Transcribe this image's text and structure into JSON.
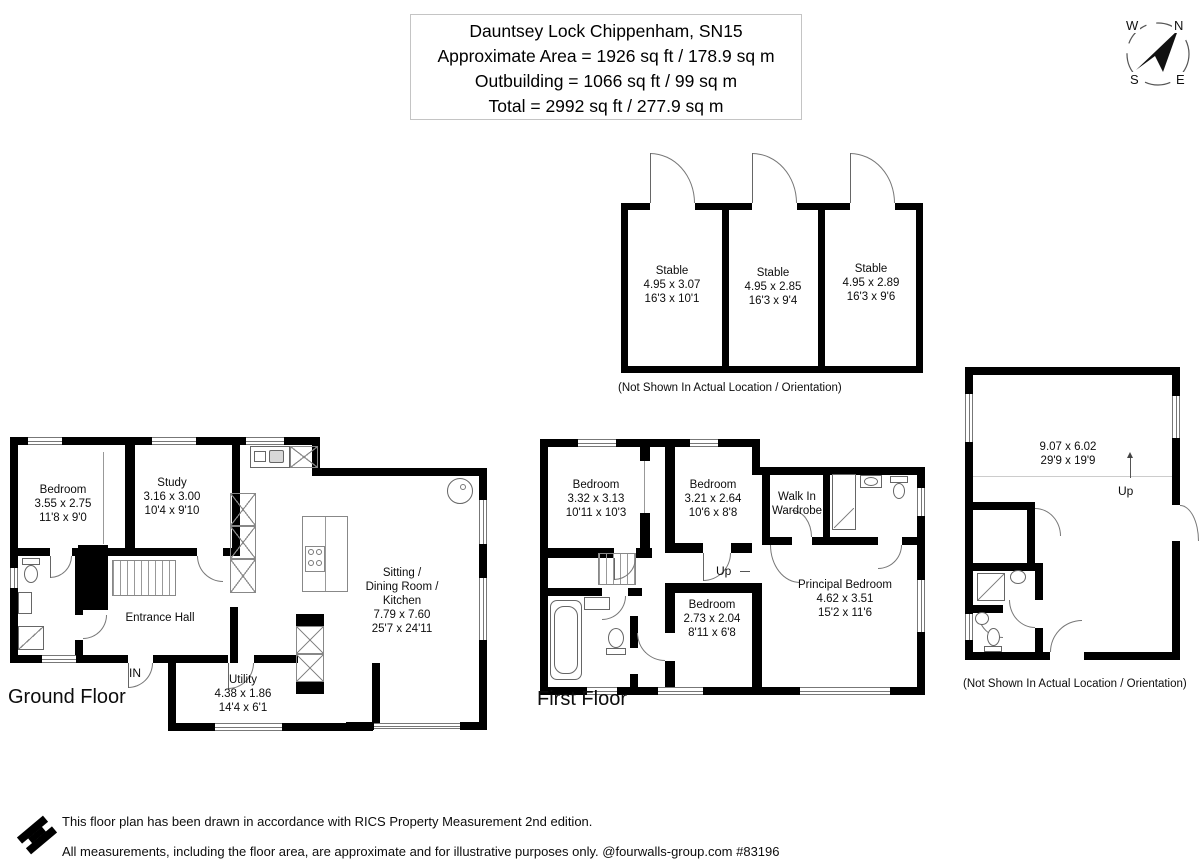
{
  "title_block": {
    "line1": "Dauntsey Lock Chippenham, SN15",
    "line2": "Approximate Area = 1926 sq ft / 178.9 sq m",
    "line3": "Outbuilding = 1066 sq ft / 99 sq m",
    "line4": "Total = 2992 sq ft / 277.9 sq m"
  },
  "compass": {
    "north": "N",
    "east": "E",
    "south": "S",
    "west": "W"
  },
  "stables": {
    "note": "(Not Shown In Actual Location / Orientation)",
    "rooms": [
      {
        "name": "Stable",
        "metric": "4.95 x 3.07",
        "imperial": "16'3 x 10'1"
      },
      {
        "name": "Stable",
        "metric": "4.95 x 2.85",
        "imperial": "16'3 x 9'4"
      },
      {
        "name": "Stable",
        "metric": "4.95 x 2.89",
        "imperial": "16'3 x 9'6"
      }
    ]
  },
  "ground_floor": {
    "label": "Ground Floor",
    "entrance_label": "IN",
    "rooms": {
      "bedroom": {
        "name": "Bedroom",
        "metric": "3.55 x 2.75",
        "imperial": "11'8 x 9'0"
      },
      "study": {
        "name": "Study",
        "metric": "3.16 x 3.00",
        "imperial": "10'4 x 9'10"
      },
      "sitting": {
        "line1": "Sitting /",
        "line2": "Dining Room /",
        "line3": "Kitchen",
        "metric": "7.79 x 7.60",
        "imperial": "25'7 x 24'11"
      },
      "entrance_hall": {
        "name": "Entrance Hall"
      },
      "utility": {
        "name": "Utility",
        "metric": "4.38 x 1.86",
        "imperial": "14'4 x 6'1"
      }
    }
  },
  "first_floor": {
    "label": "First Floor",
    "up_label": "Up",
    "rooms": {
      "bedroom1": {
        "name": "Bedroom",
        "metric": "3.32 x 3.13",
        "imperial": "10'11 x 10'3"
      },
      "bedroom2": {
        "name": "Bedroom",
        "metric": "3.21 x 2.64",
        "imperial": "10'6 x 8'8"
      },
      "walk_in_wardrobe": {
        "line1": "Walk In",
        "line2": "Wardrobe"
      },
      "principal": {
        "name": "Principal Bedroom",
        "metric": "4.62 x 3.51",
        "imperial": "15'2 x 11'6"
      },
      "bedroom3": {
        "name": "Bedroom",
        "metric": "2.73 x 2.04",
        "imperial": "8'11 x 6'8"
      }
    }
  },
  "outbuilding": {
    "metric": "9.07 x 6.02",
    "imperial": "29'9 x 19'9",
    "up_label": "Up",
    "note": "(Not Shown In Actual Location / Orientation)"
  },
  "footer": {
    "line1": "This floor plan has been drawn in accordance with RICS Property Measurement 2nd edition.",
    "line2": "All measurements, including the floor area, are approximate and for illustrative purposes only. @fourwalls-group.com #83196"
  }
}
